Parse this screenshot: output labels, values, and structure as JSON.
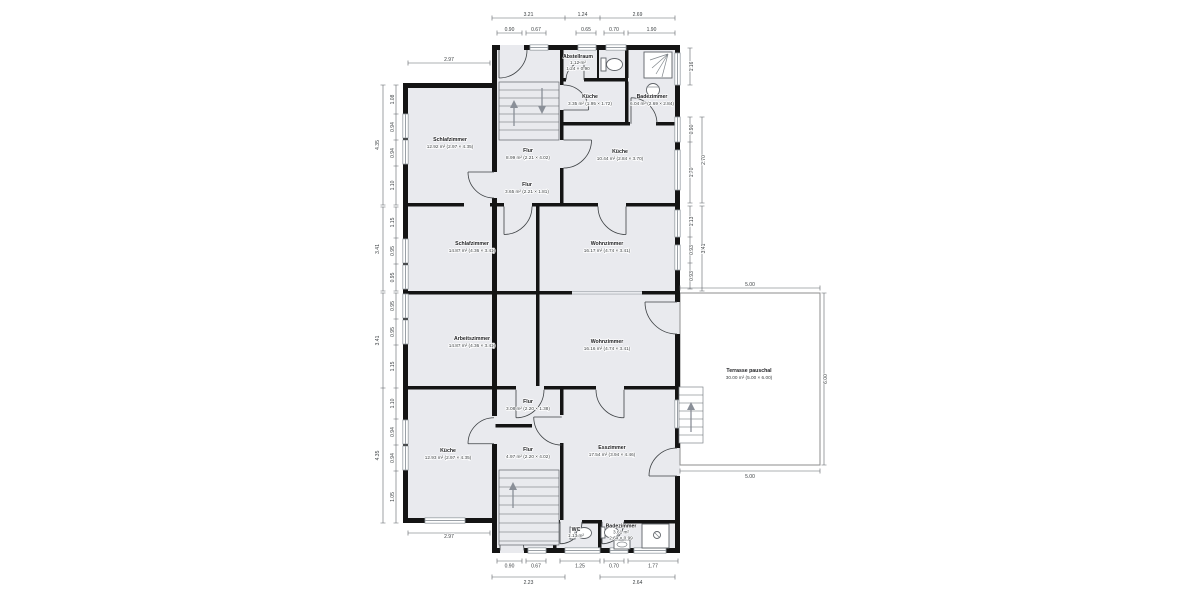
{
  "plan_title": "floor-plan",
  "colors": {
    "room_fill": "#e9eaee",
    "wall": "#141414",
    "window": "#9aa0a6",
    "dim_text": "#3c4043",
    "terrace_border": "#8d8d8d"
  },
  "rooms": {
    "schlafzimmer_top": {
      "name": "Schlafzimmer",
      "size": "12.92 m² (2.97 × 4.35)"
    },
    "flur_top": {
      "name": "Flur",
      "size": "8.99 m² (2.21 × 4.02)"
    },
    "abstellraum": {
      "name": "Abstellraum",
      "size": "1.12 m²",
      "line3": "1.24 × 0.90"
    },
    "kueche_small": {
      "name": "Küche",
      "size": "3.35 m² (1.95 × 1.72)"
    },
    "bad_top": {
      "name": "Badezimmer",
      "size": "6.04 m² (2.69 × 2.84)"
    },
    "kueche_top": {
      "name": "Küche",
      "size": "10.44 m² (2.84 × 3.70)"
    },
    "flur_mid": {
      "name": "Flur",
      "size": "3.65 m² (2.21 × 1.81)"
    },
    "schlafzimmer_mid": {
      "name": "Schlafzimmer",
      "size": "14.87 m² (4.36 × 3.41)"
    },
    "wohnzimmer_1": {
      "name": "Wohnzimmer",
      "size": "16.17 m² (4.74 × 3.41)"
    },
    "arbeitszimmer": {
      "name": "Arbeitszimmer",
      "size": "14.87 m² (4.36 × 3.41)"
    },
    "wohnzimmer_2": {
      "name": "Wohnzimmer",
      "size": "16.16 m² (4.74 × 3.41)"
    },
    "terrasse": {
      "name": "Terrasse pauschal",
      "size": "30.00 m² (5.00 × 6.00)"
    },
    "flur_3": {
      "name": "Flur",
      "size": "3.08 m² (2.20 × 1.38)"
    },
    "flur_4": {
      "name": "Flur",
      "size": "4.97 m² (2.20 × 4.02)"
    },
    "kueche_bottom": {
      "name": "Küche",
      "size": "12.93 m² (2.97 × 4.35)"
    },
    "esszimmer": {
      "name": "Esszimmer",
      "size": "17.54 m² (3.94 × 4.46)"
    },
    "wc": {
      "name": "WC",
      "size": "1.13 m²"
    },
    "bad_bottom": {
      "name": "Badezimmer",
      "size": "3.61 m²",
      "line3": "2.64 × 0.99"
    }
  },
  "dims": {
    "top1": [
      "3.21",
      "1.24",
      "2.69"
    ],
    "top2": [
      "0.90",
      "0.67",
      "0.65",
      "0.70",
      "1.90"
    ],
    "top_left": "2.97",
    "left_top": {
      "total": "4.35",
      "segs": [
        "1.08",
        "0.94",
        "0.94",
        "1.10"
      ]
    },
    "left_mid1": {
      "total": "3.41",
      "segs": [
        "1.15",
        "0.95",
        "0.95"
      ]
    },
    "left_mid2": {
      "total": "3.41",
      "segs": [
        "0.95",
        "0.95",
        "1.15"
      ]
    },
    "left_bottom": {
      "total": "4.35",
      "segs": [
        "1.10",
        "0.94",
        "0.94",
        "1.05"
      ]
    },
    "bottom_left": "2.97",
    "right_top": "1.16",
    "right_mid1": {
      "total": "2.70",
      "segs": [
        "0.90",
        "1.70"
      ]
    },
    "right_mid2": {
      "total": "3.41",
      "segs": [
        "1.13",
        "0.93",
        "0.93"
      ]
    },
    "terrace": {
      "top": "5.00",
      "right": "6.00",
      "bottom": "5.00"
    },
    "bottom1": [
      "0.90",
      "0.67",
      "1.25",
      "0.70",
      "1.77"
    ],
    "bottom2": [
      "2.23",
      "2.64"
    ]
  }
}
